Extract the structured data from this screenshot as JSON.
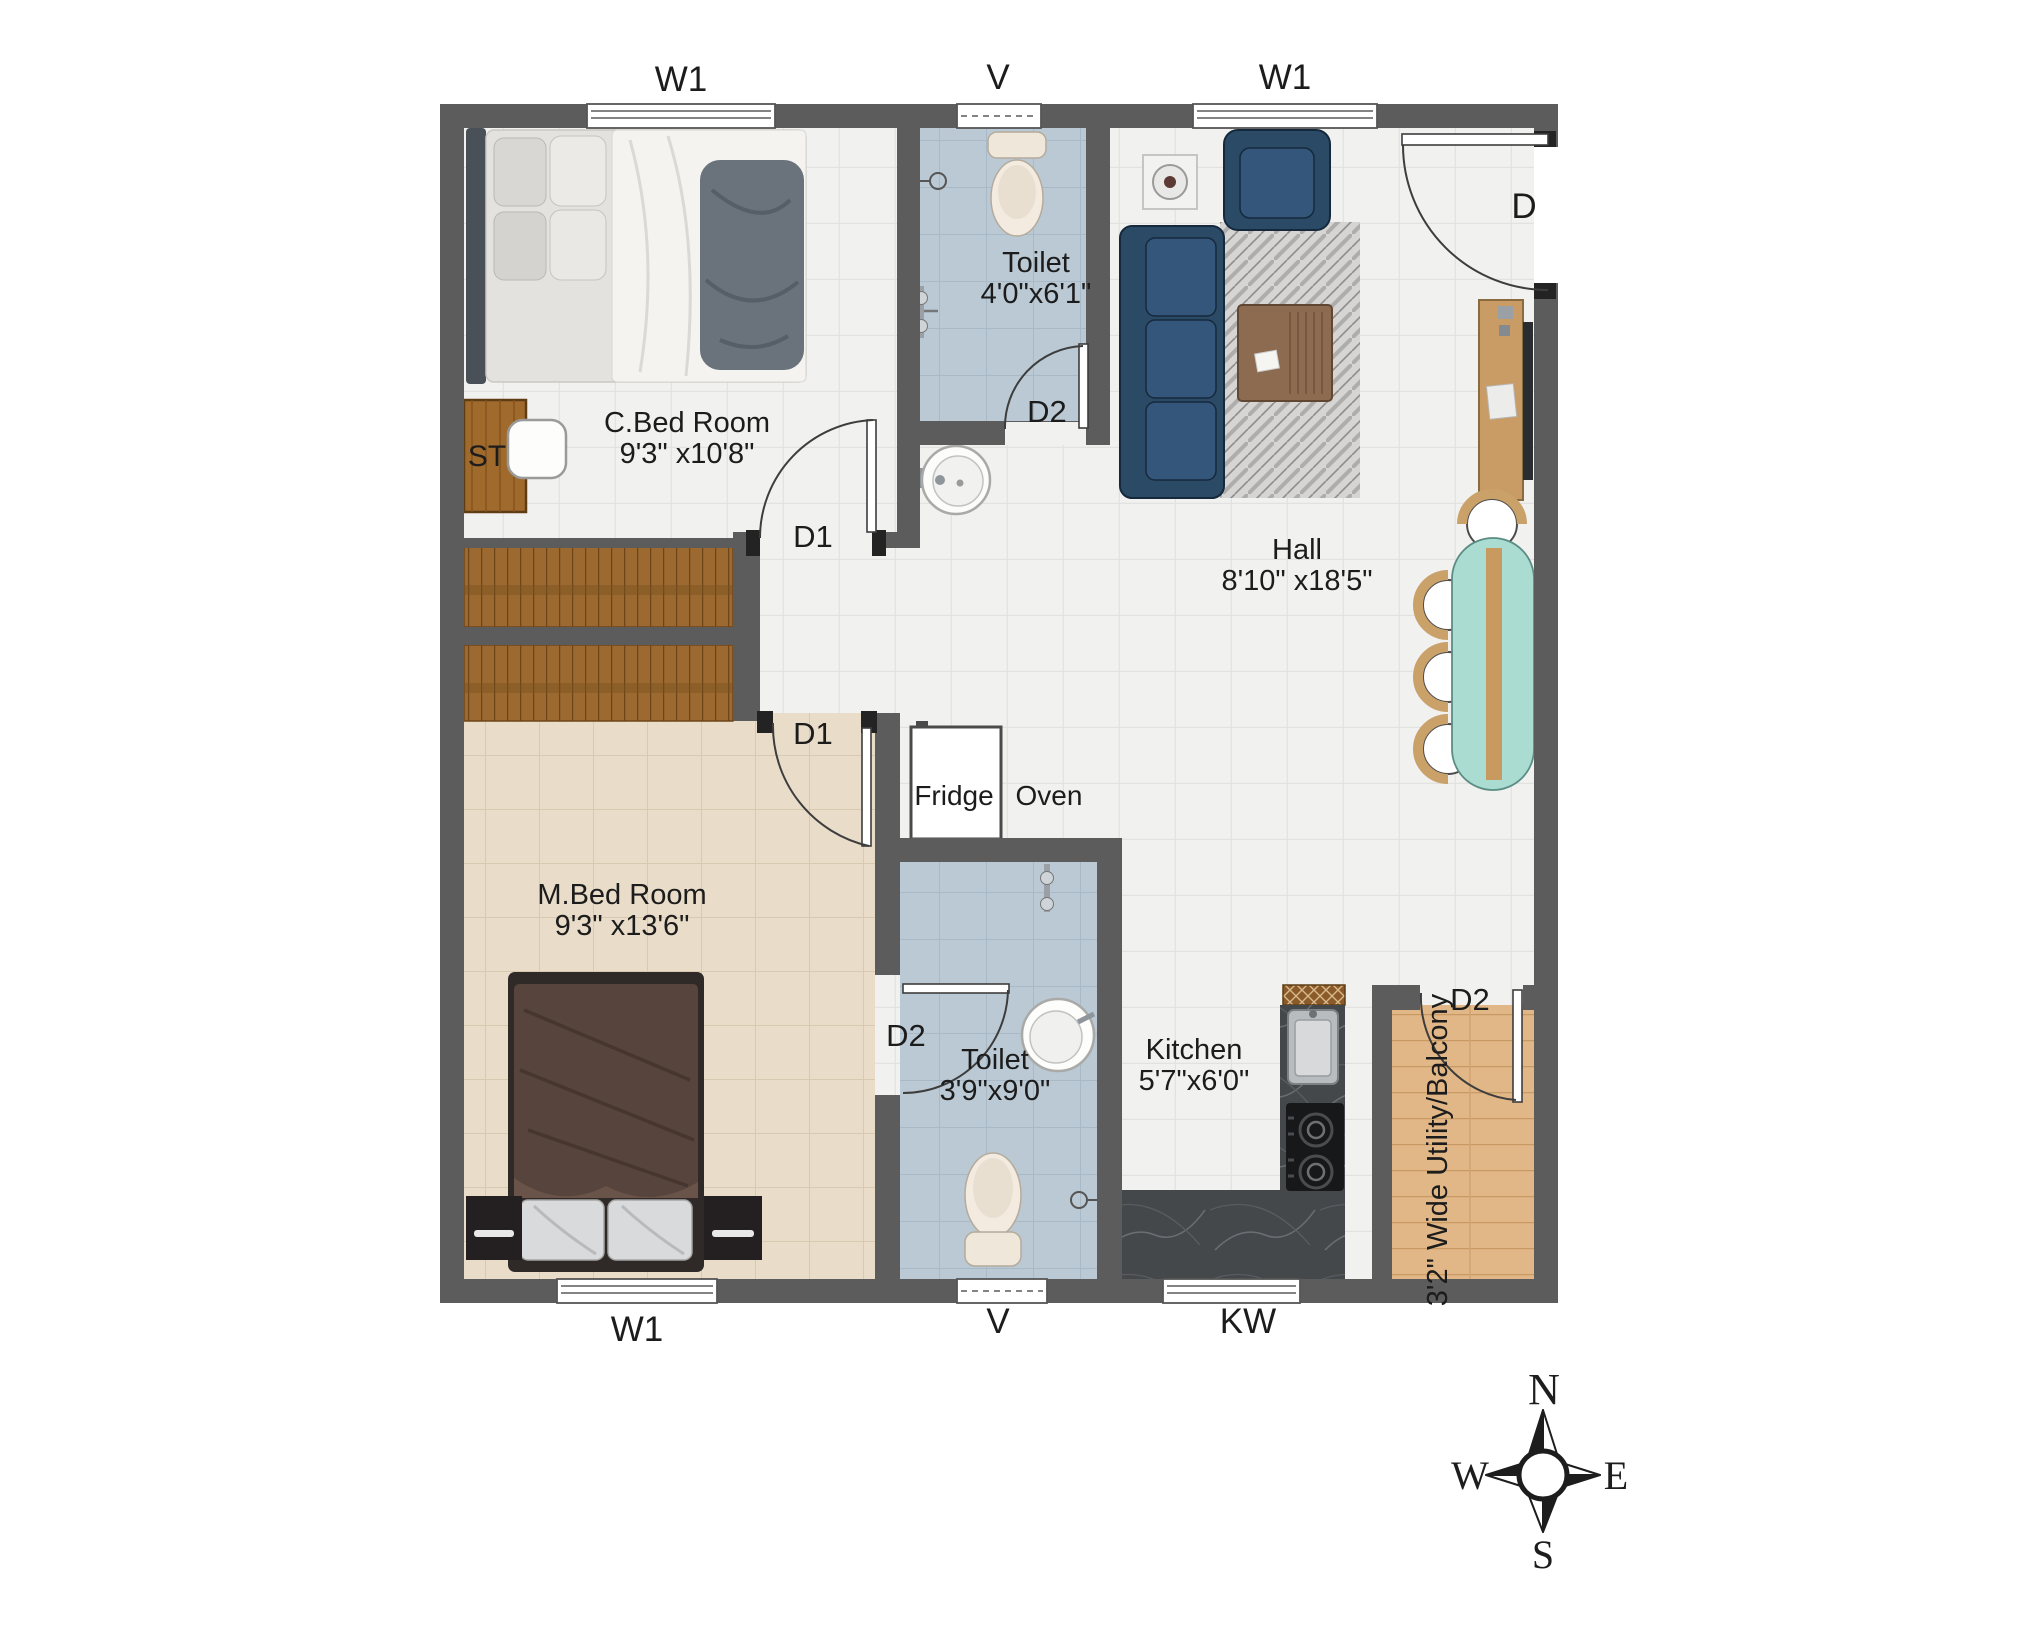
{
  "rooms": {
    "cbed": {
      "name": "C.Bed Room",
      "dims": "9'3\" x10'8\""
    },
    "toilet_top": {
      "name": "Toilet",
      "dims": "4'0\"x6'1\""
    },
    "hall": {
      "name": "Hall",
      "dims": "8'10\" x18'5\""
    },
    "mbed": {
      "name": "M.Bed Room",
      "dims": "9'3\" x13'6\""
    },
    "toilet_bottom": {
      "name": "Toilet",
      "dims": "3'9\"x9'0\""
    },
    "kitchen": {
      "name": "Kitchen",
      "dims": "5'7\"x6'0\""
    },
    "utility": {
      "name": "3'2\" Wide Utility/Balcony"
    }
  },
  "doors": {
    "main": "D",
    "cbed": "D1",
    "mbed": "D1",
    "toilet_top": "D2",
    "toilet_bottom": "D2",
    "utility": "D2"
  },
  "windows": {
    "top_left": "W1",
    "top_vent": "V",
    "top_right": "W1",
    "bottom_left": "W1",
    "bottom_vent": "V",
    "bottom_kitchen": "KW"
  },
  "fixtures": {
    "study_table": "ST",
    "fridge": "Fridge",
    "oven": "Oven"
  },
  "compass": {
    "north": "N",
    "south": "S",
    "east": "E",
    "west": "W"
  },
  "colors": {
    "wall": "#5c5c5c",
    "floor_tile": "#f1f1f0",
    "bedroom_floor": "#e9dcc9",
    "toilet_floor": "#bac9d3",
    "utility_floor": "#e2b787",
    "stairs": "#9c6a30",
    "sofa": "#2b4a66",
    "sofa_cushion": "#33567a",
    "dining_table": "#aadcd2",
    "chair_back": "#c9a169",
    "counter": "#45484b",
    "counter_hatch": "#8a5a28",
    "rug": "#d6d5d3",
    "label_text": "#1c1c1c"
  }
}
